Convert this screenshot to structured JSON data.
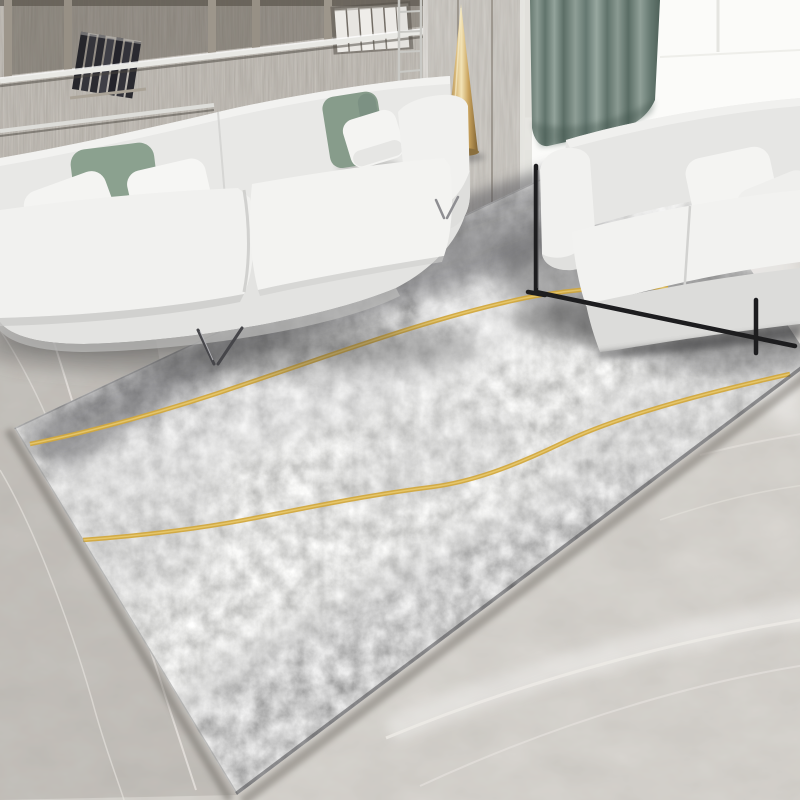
{
  "scene": {
    "type": "photograph",
    "subject": "Modern living room with a gray abstract area rug decorated with two wavy gold lines, a white fabric sofa with sage green and white pillows in front of a gray wood shelving wall, a gold cone floor lamp, a teal curtain beside a bright window, and a white loveseat on a black metal frame, all on gray marble flooring",
    "objects": [
      "wood-shelf-wall",
      "dark-leaning-books",
      "white-book-stack",
      "chrome-shelf-rail",
      "white-sofa-left",
      "sage-green-pillows",
      "white-pillows",
      "chrome-hairpin-legs",
      "metal-ladder-rack",
      "gold-cone-floor-lamp",
      "wood-panel-wall",
      "teal-curtain",
      "bright-window",
      "white-loveseat-right",
      "black-metal-sofa-frame",
      "gray-abstract-rug",
      "gold-wavy-lines",
      "marble-floor"
    ]
  },
  "colors": {
    "sofa-white": "#f1f1ef",
    "sofa-back": "#e8e8e6",
    "sofa-apron": "#e3e3e1",
    "sofa-shade": "#c9c9c7",
    "pillow-white": "#f4f4f2",
    "pillow-green": "#8ba18f",
    "pillow-green-dark": "#75897b",
    "curtain-mid": "#6f8279",
    "window-white": "#fbfbf9",
    "lamp-gold": "#d9b878",
    "lamp-gold-deep": "#8f7340",
    "frame-black": "#1d1d1f",
    "chrome": "#8e8e92",
    "rug-gold": "#d2a83d",
    "rug-gold-light": "#edd27a",
    "marble-vein": "#e9e6e1",
    "wood-divider": "#9d968b",
    "rail-light": "#e9e9e5",
    "book-dark": "#2e2e33",
    "white-book": "#eceae6",
    "shadow-dark": "#3f3f44"
  }
}
